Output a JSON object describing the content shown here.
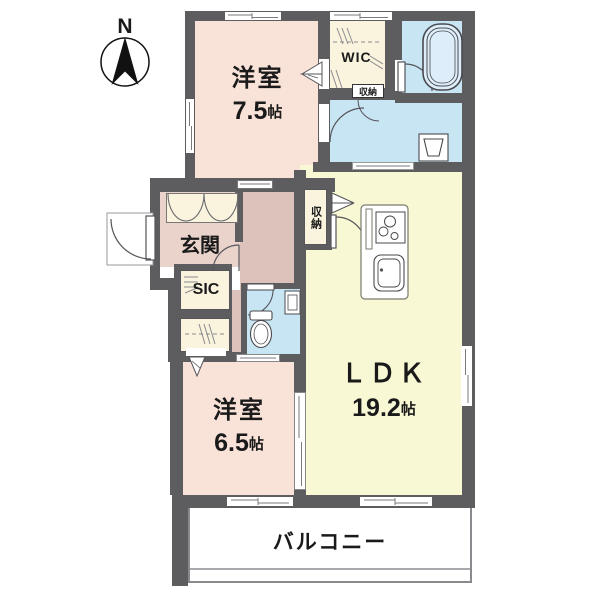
{
  "compass": {
    "label": "N"
  },
  "rooms": {
    "western1": {
      "label": "洋室",
      "size": "7.5",
      "unit": "帖"
    },
    "western2": {
      "label": "洋室",
      "size": "6.5",
      "unit": "帖"
    },
    "ldk": {
      "label": "ＬＤＫ",
      "size": "19.2",
      "unit": "帖"
    },
    "genkan": {
      "label": "玄関"
    },
    "wic": {
      "label": "WIC"
    },
    "sic": {
      "label": "SIC"
    },
    "storage_hall": {
      "label": "収納"
    },
    "storage_mini": {
      "label": "収納"
    },
    "balcony": {
      "label": "バルコニー"
    }
  },
  "fixtures": {
    "bathtub": "bathtub",
    "toilet": "toilet",
    "washbasin": "washbasin",
    "washing_machine": "washing-machine-pan",
    "stove": "gas-stove",
    "sink": "kitchen-sink",
    "north_arrow": "north-arrow"
  },
  "colors": {
    "wall": "#5d5d60",
    "room_pink": "#f9e3d8",
    "room_yellow": "#f9f8d4",
    "room_blue": "#c8e5f4",
    "closet_cream": "#faf4df",
    "genkan": "#ead3cb",
    "hall": "#dcc2ba",
    "balcony_border": "#8a8a8e"
  }
}
